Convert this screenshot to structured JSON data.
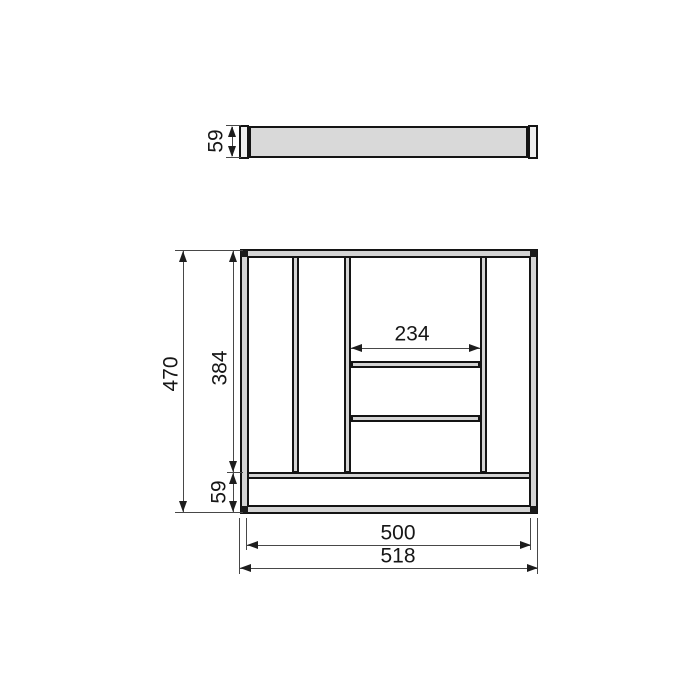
{
  "page": {
    "background": "#ffffff",
    "description": "Technical line drawing of a cutlery tray drawer insert: front elevation on top and plan view below, with millimetre dimensions"
  },
  "colors": {
    "line": "#141414",
    "dimension_line": "#474747",
    "tray_body_fill": "#d9d9d9",
    "end_cap_fill": "#efefef",
    "wall_fill": "#d4d4d4",
    "corner_block_fill": "#1a1a1a"
  },
  "front_view": {
    "height": "59"
  },
  "plan_view": {
    "total_depth": "470",
    "inner_depth": "384",
    "front_channel_depth": "59",
    "center_compartment_width": "234",
    "inner_width": "500",
    "total_width": "518"
  }
}
